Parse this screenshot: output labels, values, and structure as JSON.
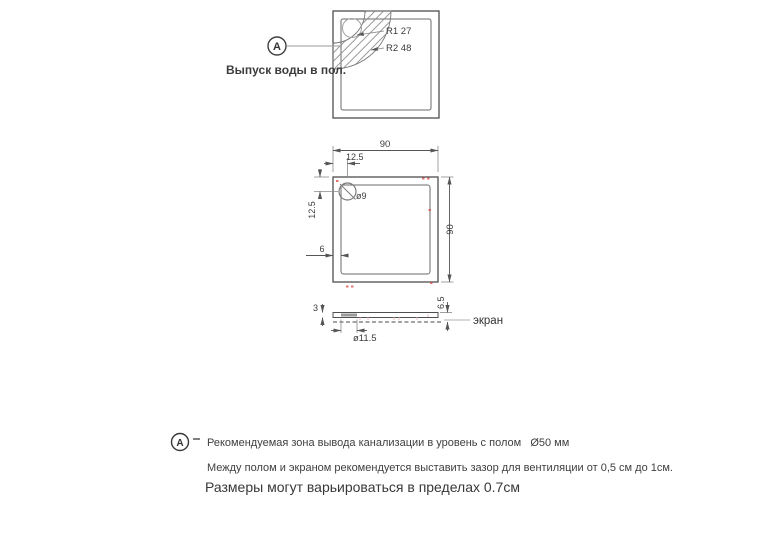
{
  "colors": {
    "line": "#555555",
    "ext_line": "#8a8a8a",
    "text": "#3c3c3c",
    "red_mark": "#d9534f",
    "hatch": "#8c8c8c"
  },
  "detail_view": {
    "marker": "A",
    "callout": "Выпуск воды в пол.",
    "radius1": "R1 27",
    "radius2": "R2 48"
  },
  "plan_view": {
    "width": "90",
    "height": "90",
    "drain_offset_x": "12.5",
    "drain_offset_y": "12.5",
    "wall": "6",
    "drain_diameter": "ø9"
  },
  "side_view": {
    "edge_height": "3",
    "total_height": "6.5",
    "drain_diameter": "ø11.5",
    "screen_label": "экран"
  },
  "notes": {
    "marker": "A",
    "line1": "Рекомендуемая зона вывода канализации в уровень с полом   Ø50 мм",
    "line2": "Между полом и экраном рекомендуется выставить зазор для вентиляции от 0,5 см до 1см.",
    "line3": "Размеры могут варьироваться в пределах 0.7см"
  }
}
